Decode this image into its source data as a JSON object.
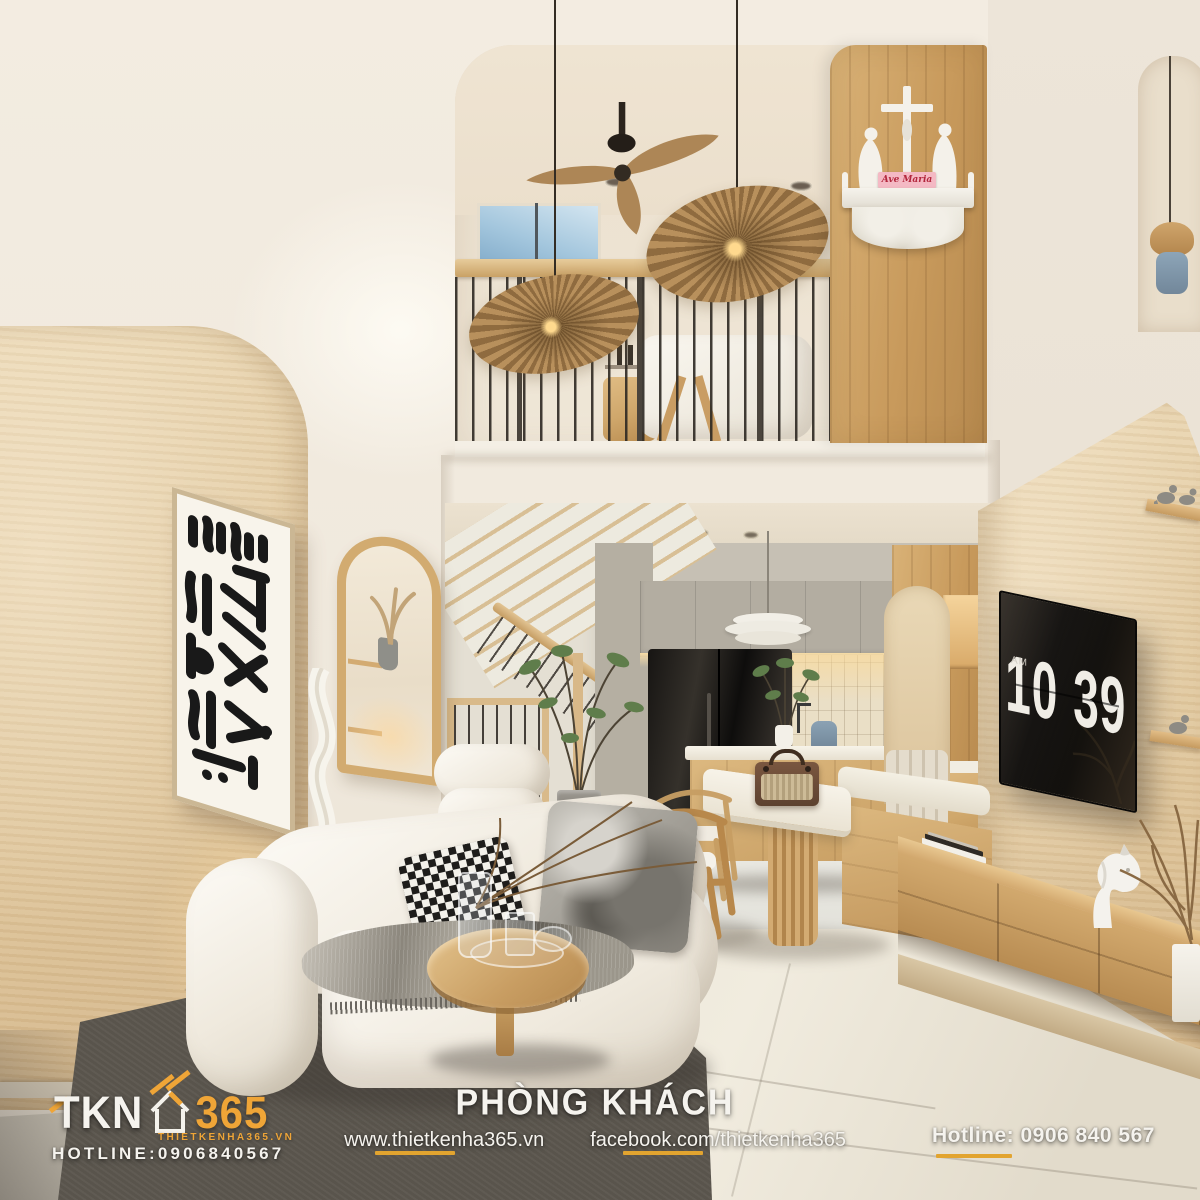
{
  "brand": {
    "logo_main": "TKN",
    "logo_number": "365",
    "site": "THIETKENHA365.VN",
    "hotline": "HOTLINE:0906840567"
  },
  "footer": {
    "room_title": "PHÒNG KHÁCH",
    "website": "www.thietkenha365.vn",
    "facebook": "facebook.com/thietkenha365",
    "hotline": "Hotline: 0906 840 567"
  },
  "tv_clock": {
    "meridiem": "AM",
    "hour": "10",
    "minute": "39"
  },
  "altar": {
    "plaque_text": "Ave Maria"
  },
  "colors": {
    "brand_gold": "#EFA537",
    "underline_gold": "#E2A42F",
    "wall_cream": "#F1EADF",
    "travertine": "#E3CEA8",
    "wood": "#CDA468",
    "rug_gray": "#59544C",
    "tv_black": "#14110D",
    "plaque_pink": "#F4B9C4",
    "plaque_red": "#B3273D"
  }
}
